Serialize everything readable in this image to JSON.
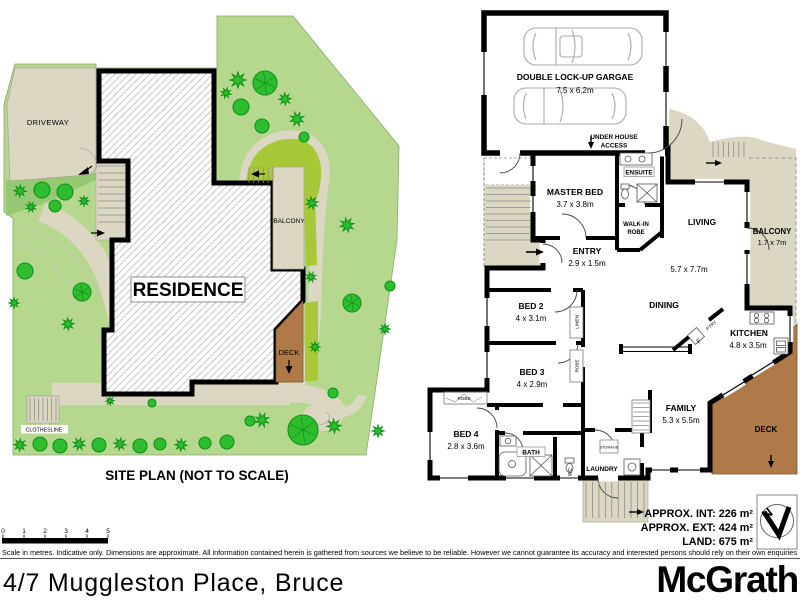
{
  "site_plan": {
    "caption": "SITE PLAN (NOT TO SCALE)",
    "residence_label": "RESIDENCE",
    "driveway_label": "DRIVEWAY",
    "balcony_label": "BALCONY",
    "deck_label": "DECK",
    "clothesline_label": "CLOTHESLINE"
  },
  "floor_plan": {
    "garage": {
      "name": "DOUBLE LOCK-UP GARGAE",
      "dims": "7.5 x 6.2m"
    },
    "under_house": {
      "line1": "UNDER HOUSE",
      "line2": "ACCESS"
    },
    "master_bed": {
      "name": "MASTER BED",
      "dims": "3.7 x 3.8m"
    },
    "ensuite": "ENSUITE",
    "walk_in_robe": {
      "line1": "WALK-IN",
      "line2": "ROBE"
    },
    "entry": {
      "name": "ENTRY",
      "dims": "2.9 x 1.5m"
    },
    "living": {
      "name": "LIVING",
      "dims": "5.7 x 7.7m"
    },
    "balcony": {
      "name": "BALCONY",
      "dims": "1.7 x 7m"
    },
    "bed2": {
      "name": "BED 2",
      "dims": "4 x 3.1m"
    },
    "bed3": {
      "name": "BED 3",
      "dims": "4 x 2.9m"
    },
    "bed4": {
      "name": "BED 4",
      "dims": "2.8 x 3.6m"
    },
    "dining": "DINING",
    "kitchen": {
      "name": "KITCHEN",
      "dims": "4.8 x 3.5m"
    },
    "family": {
      "name": "FAMILY",
      "dims": "5.3 x 5.5m"
    },
    "deck": "DECK",
    "bath": "BATH",
    "wc": "WC",
    "laundry": "LAUNDRY",
    "linen": "LINEN",
    "robe": "ROBE",
    "storage": "STORAGE",
    "pantry": "PTRY",
    "fridge": "F",
    "compass": "N",
    "stats": [
      "APPROX. INT: 226 m²",
      "APPROX. EXT: 424 m²",
      "LAND: 675 m²"
    ]
  },
  "scale_bar": {
    "ticks": [
      "0",
      "1",
      "2",
      "3",
      "4",
      "5"
    ],
    "note": "Scale in metres. Indicative only. Dimensions are approximate. All information contained herein is gathered from sources we believe to be reliable. However we cannot guarantee its accuracy and interested persons should rely on their own enquiries"
  },
  "footer": {
    "address": "4/7 Muggleston Place, Bruce",
    "brand": "McGrath"
  },
  "colors": {
    "grass": "#b5d88e",
    "grass_dark": "#96c973",
    "lawn": "#a9c838",
    "tree": "#2ebd2e",
    "tree_outline": "#12921a",
    "paving": "#dbd7c2",
    "deck": "#b07a48",
    "wall": "#000000"
  }
}
